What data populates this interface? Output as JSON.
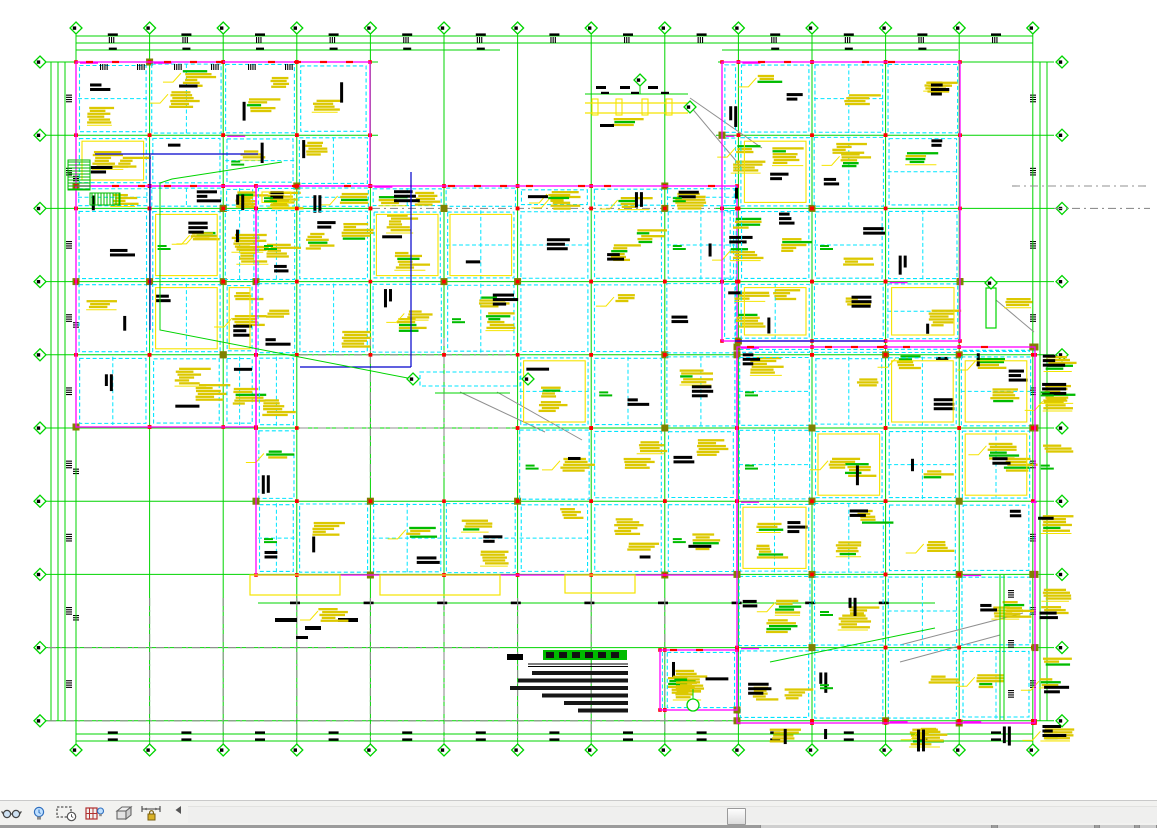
{
  "window": {
    "canvas_background": "#ffffff",
    "toolbar_background": "#f2f2f0",
    "status_edge_background": "#9b9b9b"
  },
  "drawing": {
    "description": "structural-framing-plan",
    "colors": {
      "grid": "#00d400",
      "beam": "#00e5ff",
      "boundary": "#ff00ff",
      "annotation": "#dcc800",
      "annotation_bright": "#f5e400",
      "text_dark": "#000000",
      "column": "#ff0000",
      "joint": "#808000",
      "leader_gray": "#8f8f8f",
      "detail_blue": "#0000cc",
      "hatch_green": "#00bb00",
      "grid_gray": "#909090"
    },
    "grid": {
      "columns": {
        "count": 14,
        "start_x": 76,
        "spacing": 73.6,
        "bubble_top_y": 28,
        "bubble_bottom_y": 750,
        "line_top_y": 34,
        "line_bottom_y": 744
      },
      "rows": {
        "count": 10,
        "start_y": 62,
        "spacing": 73.2,
        "bubble_left_x": 40,
        "bubble_right_x": 1062,
        "line_left_x": 48,
        "line_right_x": 1054
      },
      "bubble_radius": 6,
      "row_segments_special": {
        "0": [
          [
            48,
            378
          ],
          [
            718,
            1054
          ]
        ],
        "1": [
          [
            48,
            378
          ],
          [
            716,
            1054
          ]
        ],
        "2": [
          [
            48,
            372
          ],
          [
            716,
            1054
          ]
        ]
      }
    },
    "dimension_lines": {
      "top_y": [
        36,
        43
      ],
      "top_partial": {
        "y": 50,
        "ranges": [
          [
            76,
            500
          ],
          [
            722,
            958
          ]
        ]
      },
      "bottom_y": [
        734,
        741
      ],
      "left_x": [
        51,
        58,
        65
      ],
      "right_x": [
        1040,
        1047
      ],
      "sub_bottom": {
        "y": 603,
        "x0": 258,
        "x1": 935
      }
    },
    "regions": [
      {
        "name": "wing-top-left",
        "x": 76,
        "y": 62,
        "w": 294,
        "h": 124
      },
      {
        "name": "wing-left",
        "x": 76,
        "y": 186,
        "w": 180,
        "h": 241
      },
      {
        "name": "block-main",
        "x": 256,
        "y": 186,
        "w": 481,
        "h": 389,
        "hole": {
          "x": 300,
          "y": 338,
          "w": 220,
          "h": 140
        }
      },
      {
        "name": "block-top-right",
        "x": 722,
        "y": 62,
        "w": 238,
        "h": 279
      },
      {
        "name": "block-low-right",
        "x": 737,
        "y": 347,
        "w": 298,
        "h": 376
      },
      {
        "name": "block-bottom-mid",
        "x": 660,
        "y": 650,
        "w": 77,
        "h": 60
      }
    ],
    "gray_overlays": {
      "h": [
        [
          340,
          186,
          720
        ],
        [
          1012,
          186,
          1150
        ],
        [
          372,
          208.4,
          716
        ],
        [
          1054,
          208.4,
          1150
        ],
        [
          300,
          354.8,
          520
        ],
        [
          300,
          428,
          520
        ],
        [
          48,
          647.6,
          500
        ],
        [
          48,
          720.8,
          737
        ]
      ],
      "v": [
        [
          370.4,
          338,
          478
        ],
        [
          444,
          338,
          478
        ],
        [
          149.6,
          598,
          743
        ],
        [
          223.2,
          598,
          743
        ],
        [
          296.8,
          598,
          743
        ],
        [
          370.4,
          598,
          743
        ],
        [
          444,
          598,
          743
        ],
        [
          517.6,
          598,
          743
        ],
        [
          591.2,
          598,
          743
        ],
        [
          664.8,
          598,
          743
        ]
      ],
      "diag": [
        [
          690,
          98,
          762,
          148
        ],
        [
          690,
          106,
          742,
          168
        ],
        [
          460,
          392,
          545,
          432
        ],
        [
          497,
          392,
          582,
          440
        ],
        [
          900,
          645,
          1023,
          613
        ],
        [
          900,
          662,
          1000,
          635
        ],
        [
          996,
          300,
          1034,
          332
        ]
      ]
    },
    "blue_lines": [
      [
        150,
        155,
        150,
        330
      ],
      [
        411,
        172,
        411,
        367
      ],
      [
        300,
        367,
        411,
        367
      ],
      [
        95,
        154,
        258,
        154
      ],
      [
        735,
        341,
        885,
        341
      ]
    ],
    "green_leaders": {
      "poly": [
        [
          282,
          162,
          172,
          179,
          160,
          183,
          160,
          330,
          418,
          380
        ]
      ],
      "line": [
        [
          935,
          628,
          770,
          662
        ]
      ]
    },
    "hatches": [
      {
        "x": 68,
        "y": 160,
        "w": 22,
        "h": 30,
        "dir": "h"
      },
      {
        "x": 90,
        "y": 193,
        "w": 30,
        "h": 12,
        "dir": "v"
      }
    ],
    "canopy_top": {
      "x": 585,
      "y": 88,
      "w": 103
    },
    "canopy_court": {
      "x": 420,
      "y": 372,
      "w": 100,
      "h": 14
    },
    "detail_right": {
      "x": 986,
      "y": 288,
      "w": 10,
      "h": 40
    },
    "inner_dim_right": {
      "x": [
        1000,
        1004
      ],
      "y0": 575,
      "y1": 720
    },
    "bottom_yellow_boxes": [
      [
        250,
        575,
        90,
        20
      ],
      [
        380,
        575,
        120,
        20
      ],
      [
        565,
        575,
        70,
        18
      ]
    ],
    "bottom_black_bars": [
      [
        275,
        618,
        22,
        4
      ],
      [
        305,
        626,
        16,
        4
      ],
      [
        338,
        618,
        20,
        4
      ],
      [
        296,
        636,
        12,
        3
      ]
    ],
    "circle_marker": {
      "cx": 693,
      "cy": 705,
      "r": 6
    },
    "notes": {
      "mark": {
        "x": 507,
        "y": 654,
        "w": 16,
        "h": 6
      },
      "title_highlight": {
        "x": 543,
        "y": 650,
        "w": 84,
        "h": 10
      },
      "underline": {
        "x0": 528,
        "x1": 628,
        "y": 664
      },
      "line_right_edge": 628,
      "line_widths": [
        96,
        110,
        118,
        86,
        64,
        50
      ],
      "line_y0": 671,
      "line_dy": 7.5
    }
  },
  "view_control_bar": {
    "icons": [
      {
        "name": "temporary-hide-isolate",
        "glyph": "glasses",
        "left": 1
      },
      {
        "name": "reveal-hidden-elements",
        "glyph": "bulb",
        "left": 31
      },
      {
        "name": "temporary-view-properties",
        "glyph": "cropclock",
        "left": 56
      },
      {
        "name": "analytical-model",
        "glyph": "framebulb",
        "left": 84
      },
      {
        "name": "displacement-sets",
        "glyph": "box3d",
        "left": 114
      },
      {
        "name": "reveal-constraints",
        "glyph": "dimlock",
        "left": 140
      },
      {
        "name": "collapse-arrow",
        "glyph": "arrowleft",
        "left": 174
      }
    ]
  },
  "scrollbar": {
    "thumb_left": 727,
    "thumb_top": 806,
    "thumb_width": 19,
    "thumb_height": 17
  },
  "status_segments": [
    {
      "x": 760,
      "w": 232
    },
    {
      "x": 997,
      "w": 98
    },
    {
      "x": 1099,
      "w": 36
    },
    {
      "x": 1139,
      "w": 18
    }
  ]
}
